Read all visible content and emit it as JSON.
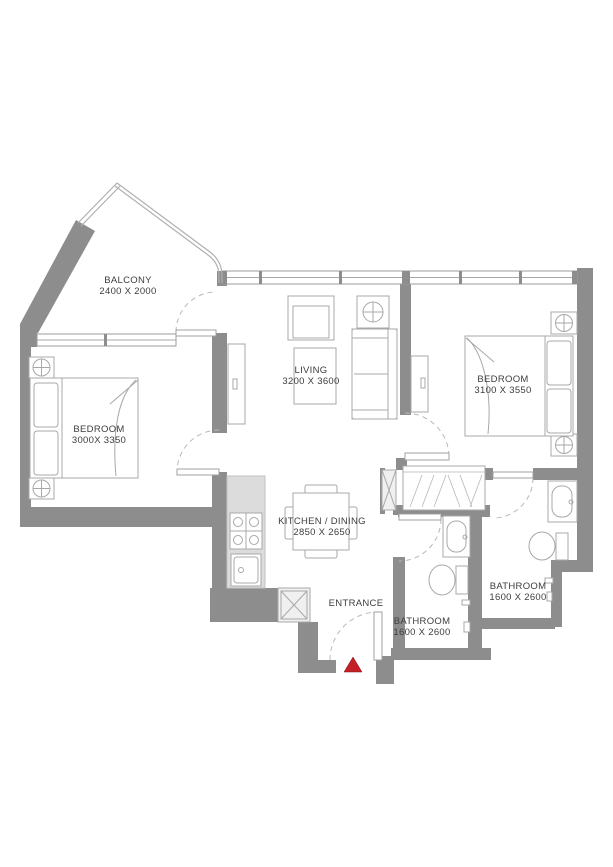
{
  "rooms": {
    "balcony": {
      "name": "BALCONY",
      "dims": "2400 X 2000"
    },
    "bedroom1": {
      "name": "BEDROOM",
      "dims": "3000X 3350"
    },
    "living": {
      "name": "LIVING",
      "dims": "3200 X 3600"
    },
    "bedroom2": {
      "name": "BEDROOM",
      "dims": "3100 X 3550"
    },
    "kitchen": {
      "name": "KITCHEN / DINING",
      "dims": "2850 X 2650"
    },
    "bathroom1": {
      "name": "BATHROOM",
      "dims": "1600 X 2600"
    },
    "bathroom2": {
      "name": "BATHROOM",
      "dims": "1600 X 2600"
    },
    "entrance": {
      "label": "ENTRANCE"
    }
  },
  "colors": {
    "wall": "#8d8d8d",
    "furniture_line": "#a8a8a8",
    "counter": "#dcdcdc",
    "label_text": "#3d3d3d",
    "entrance_marker": "#c42127"
  }
}
